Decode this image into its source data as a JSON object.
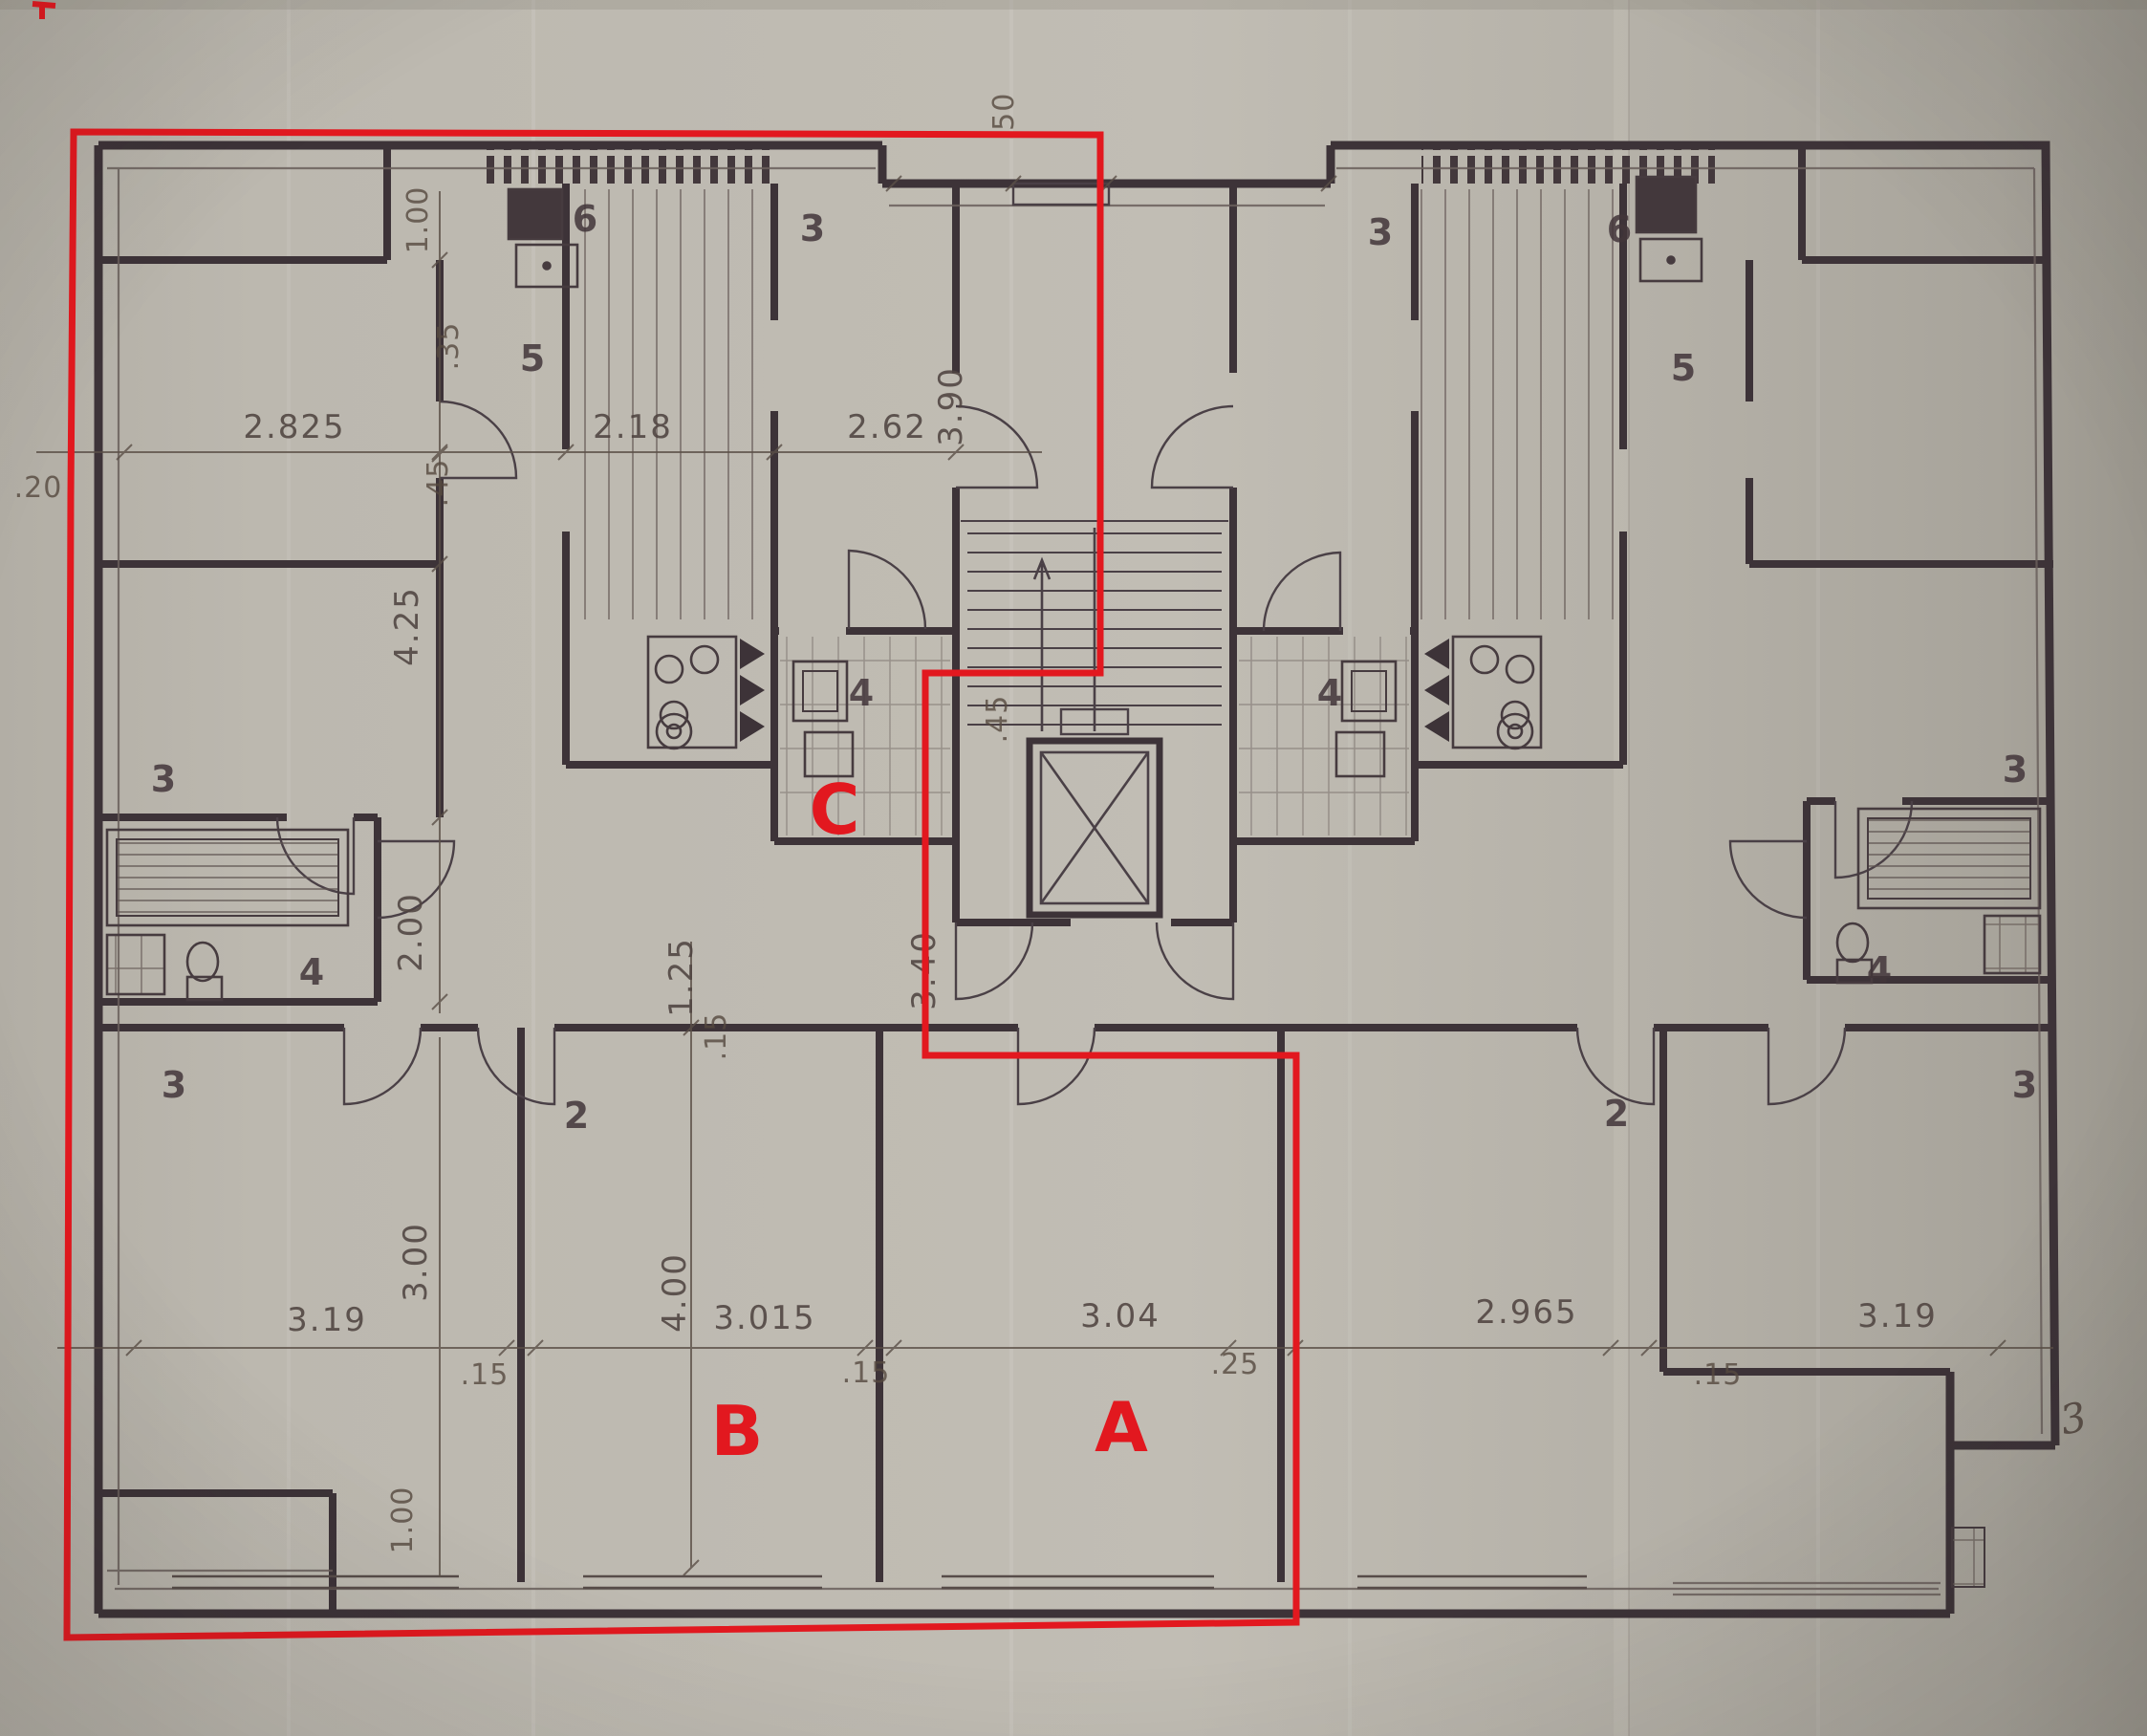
{
  "red_overlay": {
    "color": "#e2181f",
    "apartment_labels": {
      "a": "A",
      "b": "B",
      "c": "C"
    }
  },
  "dims": {
    "top": [
      "2.825",
      "2.18",
      "2.62"
    ],
    "left_margin": ".20",
    "vertical_left": [
      "1.00",
      ".35",
      ".45",
      "4.25",
      "2.00",
      "3.00",
      "1.00"
    ],
    "vertical_mid": [
      ".50",
      "3.90",
      ".45",
      "3.40",
      "1.25",
      ".15",
      "4.00"
    ],
    "bottom": [
      "3.19",
      ".15",
      "3.015",
      ".15",
      "3.04",
      ".25",
      "2.965",
      ".15",
      "3.19"
    ]
  },
  "room_numbers": {
    "left_unit": [
      "6",
      "3",
      "5",
      "4",
      "3",
      "4",
      "2",
      "3"
    ],
    "right_unit": [
      "3",
      "6",
      "5",
      "4",
      "3",
      "4",
      "2",
      "3"
    ]
  },
  "handwritten_note": "3",
  "colors": {
    "paper": "#b8b4ab",
    "ink": "#3d3338",
    "dim_text": "#4f4440",
    "red": "#e2181f"
  }
}
